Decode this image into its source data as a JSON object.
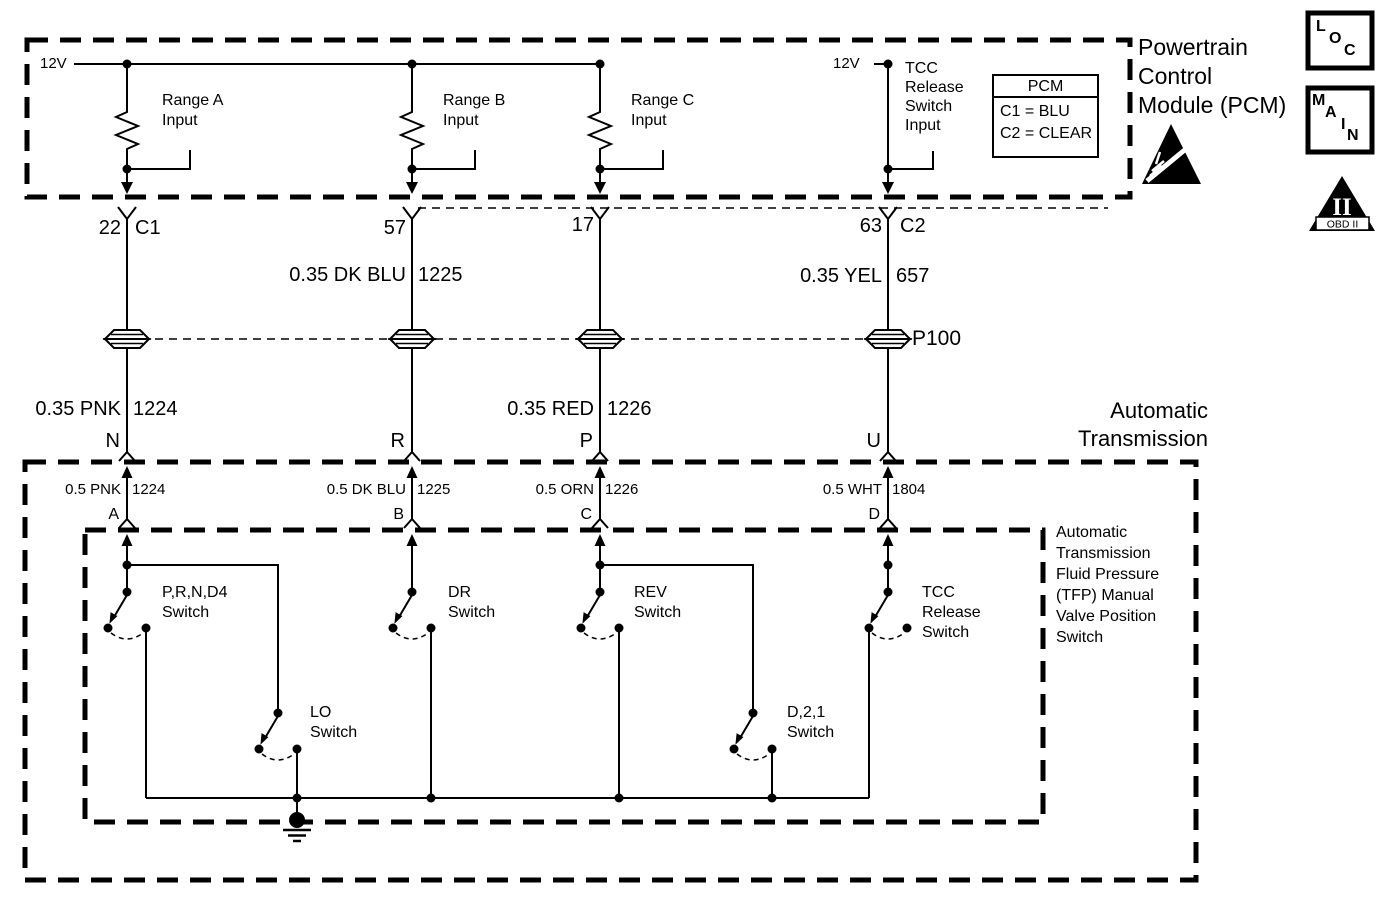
{
  "pcm_box": {
    "title": "Powertrain\nControl\nModule (PCM)",
    "supply_left": "12V",
    "supply_right": "12V",
    "range_a": "Range A\nInput",
    "range_b": "Range B\nInput",
    "range_c": "Range C\nInput",
    "tcc_input": "TCC\nRelease\nSwitch\nInput",
    "legend": {
      "header": "PCM",
      "rows": [
        "C1 = BLU",
        "C2 = CLEAR"
      ]
    }
  },
  "harness": {
    "pin_22": "22",
    "conn_c1": "C1",
    "pin_57": "57",
    "pin_17": "17",
    "pin_63": "63",
    "conn_c2": "C2",
    "wire_1225": {
      "gauge": "0.35 DK BLU",
      "circuit": "1225"
    },
    "wire_657": {
      "gauge": "0.35 YEL",
      "circuit": "657"
    },
    "pass_through": "P100",
    "wire_1224": {
      "gauge": "0.35 PNK",
      "circuit": "1224"
    },
    "wire_1226": {
      "gauge": "0.35 RED",
      "circuit": "1226"
    },
    "trans_pins": [
      "N",
      "R",
      "P",
      "U"
    ]
  },
  "transmission": {
    "title": "Automatic\nTransmission",
    "wires": [
      {
        "gauge": "0.5 PNK",
        "circuit": "1224"
      },
      {
        "gauge": "0.5 DK BLU",
        "circuit": "1225"
      },
      {
        "gauge": "0.5 ORN",
        "circuit": "1226"
      },
      {
        "gauge": "0.5 WHT",
        "circuit": "1804"
      }
    ],
    "pins": [
      "A",
      "B",
      "C",
      "D"
    ],
    "tfp_title": "Automatic\nTransmission\nFluid Pressure\n(TFP) Manual\nValve Position\nSwitch",
    "switches": {
      "prnd4": "P,R,N,D4\nSwitch",
      "dr": "DR\nSwitch",
      "rev": "REV\nSwitch",
      "tcc_release": "TCC\nRelease\nSwitch",
      "lo": "LO\nSwitch",
      "d21": "D,2,1\nSwitch"
    }
  },
  "badges": {
    "loc": [
      "L",
      "O",
      "C"
    ],
    "main": [
      "M",
      "A",
      "I",
      "N"
    ],
    "obd": {
      "numeral": "II",
      "label": "OBD II"
    }
  },
  "colors": {
    "line": "#000000",
    "background": "#ffffff"
  }
}
